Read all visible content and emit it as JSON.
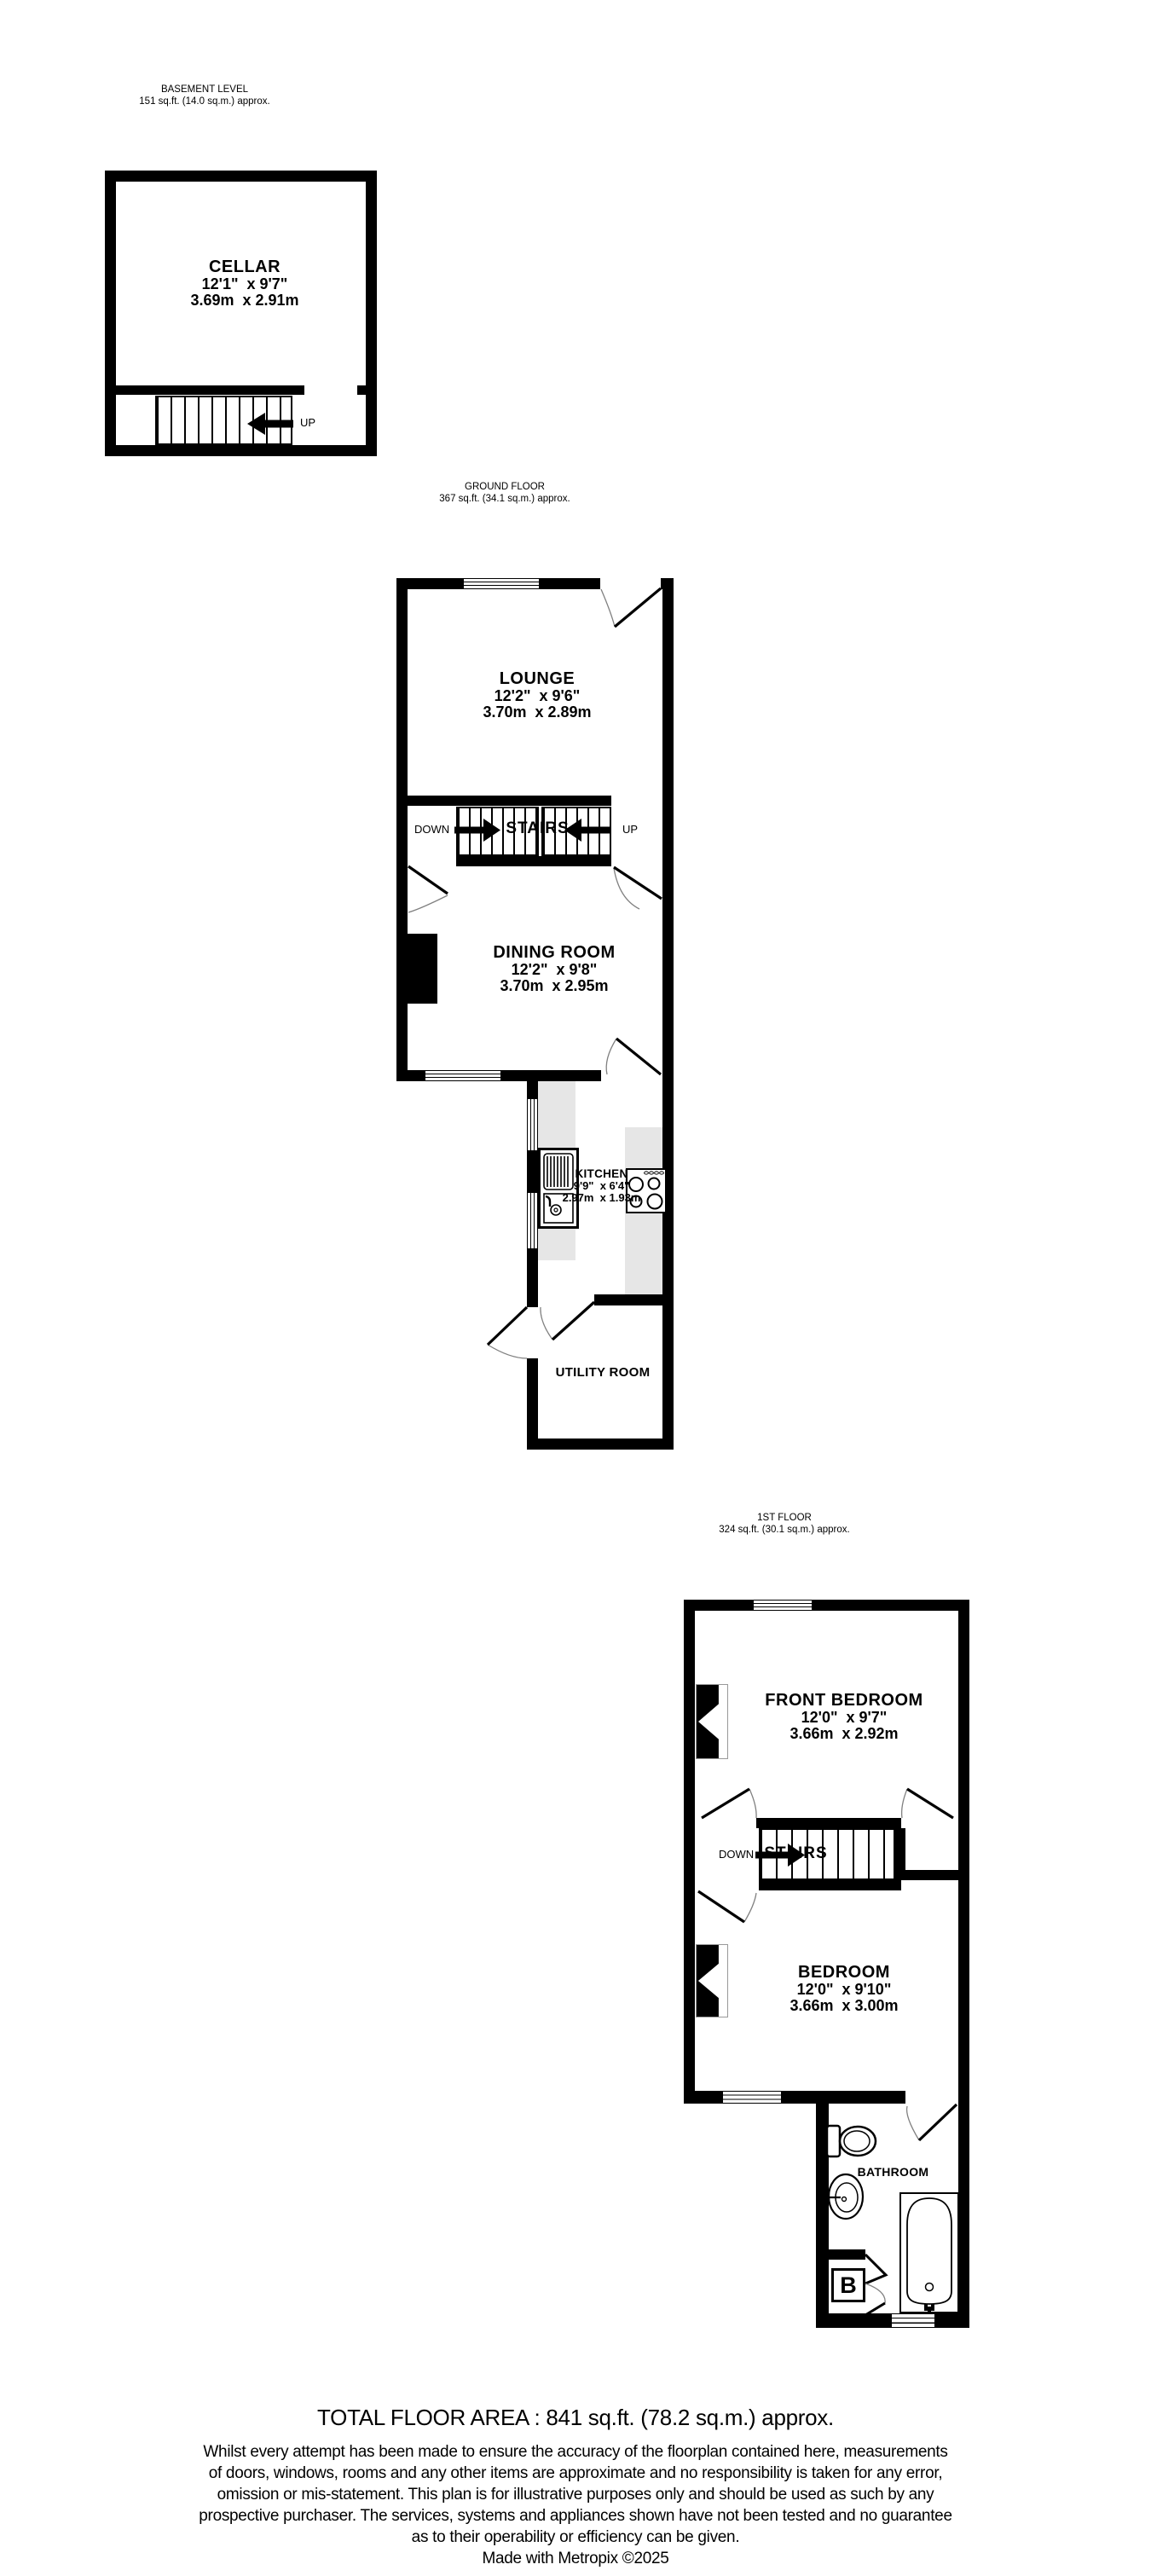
{
  "colors": {
    "wall": "#000000",
    "counter": "#e6e6e6",
    "arc_stroke": "#808080"
  },
  "floors": {
    "basement": {
      "title": "BASEMENT LEVEL",
      "area": "151 sq.ft. (14.0 sq.m.) approx.",
      "cellar_name": "CELLAR",
      "cellar_imperial": "12'1\"  x 9'7\"",
      "cellar_metric": "3.69m  x 2.91m",
      "up": "UP"
    },
    "ground": {
      "title": "GROUND FLOOR",
      "area": "367 sq.ft. (34.1 sq.m.) approx.",
      "lounge_name": "LOUNGE",
      "lounge_imperial": "12'2\"  x 9'6\"",
      "lounge_metric": "3.70m  x 2.89m",
      "dining_name": "DINING ROOM",
      "dining_imperial": "12'2\"  x 9'8\"",
      "dining_metric": "3.70m  x 2.95m",
      "kitchen_name": "KITCHEN",
      "kitchen_imperial": "9'9\"  x 6'4\"",
      "kitchen_metric": "2.97m  x 1.93m",
      "utility_name": "UTILITY ROOM",
      "stairs": "STAIRS",
      "down": "DOWN",
      "up": "UP"
    },
    "first": {
      "title": "1ST FLOOR",
      "area": "324 sq.ft. (30.1 sq.m.) approx.",
      "front_bedroom_name": "FRONT BEDROOM",
      "front_bedroom_imperial": "12'0\"  x 9'7\"",
      "front_bedroom_metric": "3.66m  x 2.92m",
      "bedroom_name": "BEDROOM",
      "bedroom_imperial": "12'0\"  x 9'10\"",
      "bedroom_metric": "3.66m  x 3.00m",
      "bathroom_name": "BATHROOM",
      "boiler": "B",
      "stairs": "STAIRS",
      "down": "DOWN"
    }
  },
  "footer": {
    "total": "TOTAL FLOOR AREA : 841 sq.ft. (78.2 sq.m.) approx.",
    "disclaimer_lines": [
      "Whilst every attempt has been made to ensure the accuracy of the floorplan contained here, measurements",
      "of doors, windows, rooms and any other items are approximate and no responsibility is taken for any error,",
      "omission or mis-statement. This plan is for illustrative purposes only and should be used as such by any",
      "prospective purchaser. The services, systems and appliances shown have not been tested and no guarantee",
      "as to their operability or efficiency can be given."
    ],
    "credit": "Made with Metropix ©2025"
  }
}
